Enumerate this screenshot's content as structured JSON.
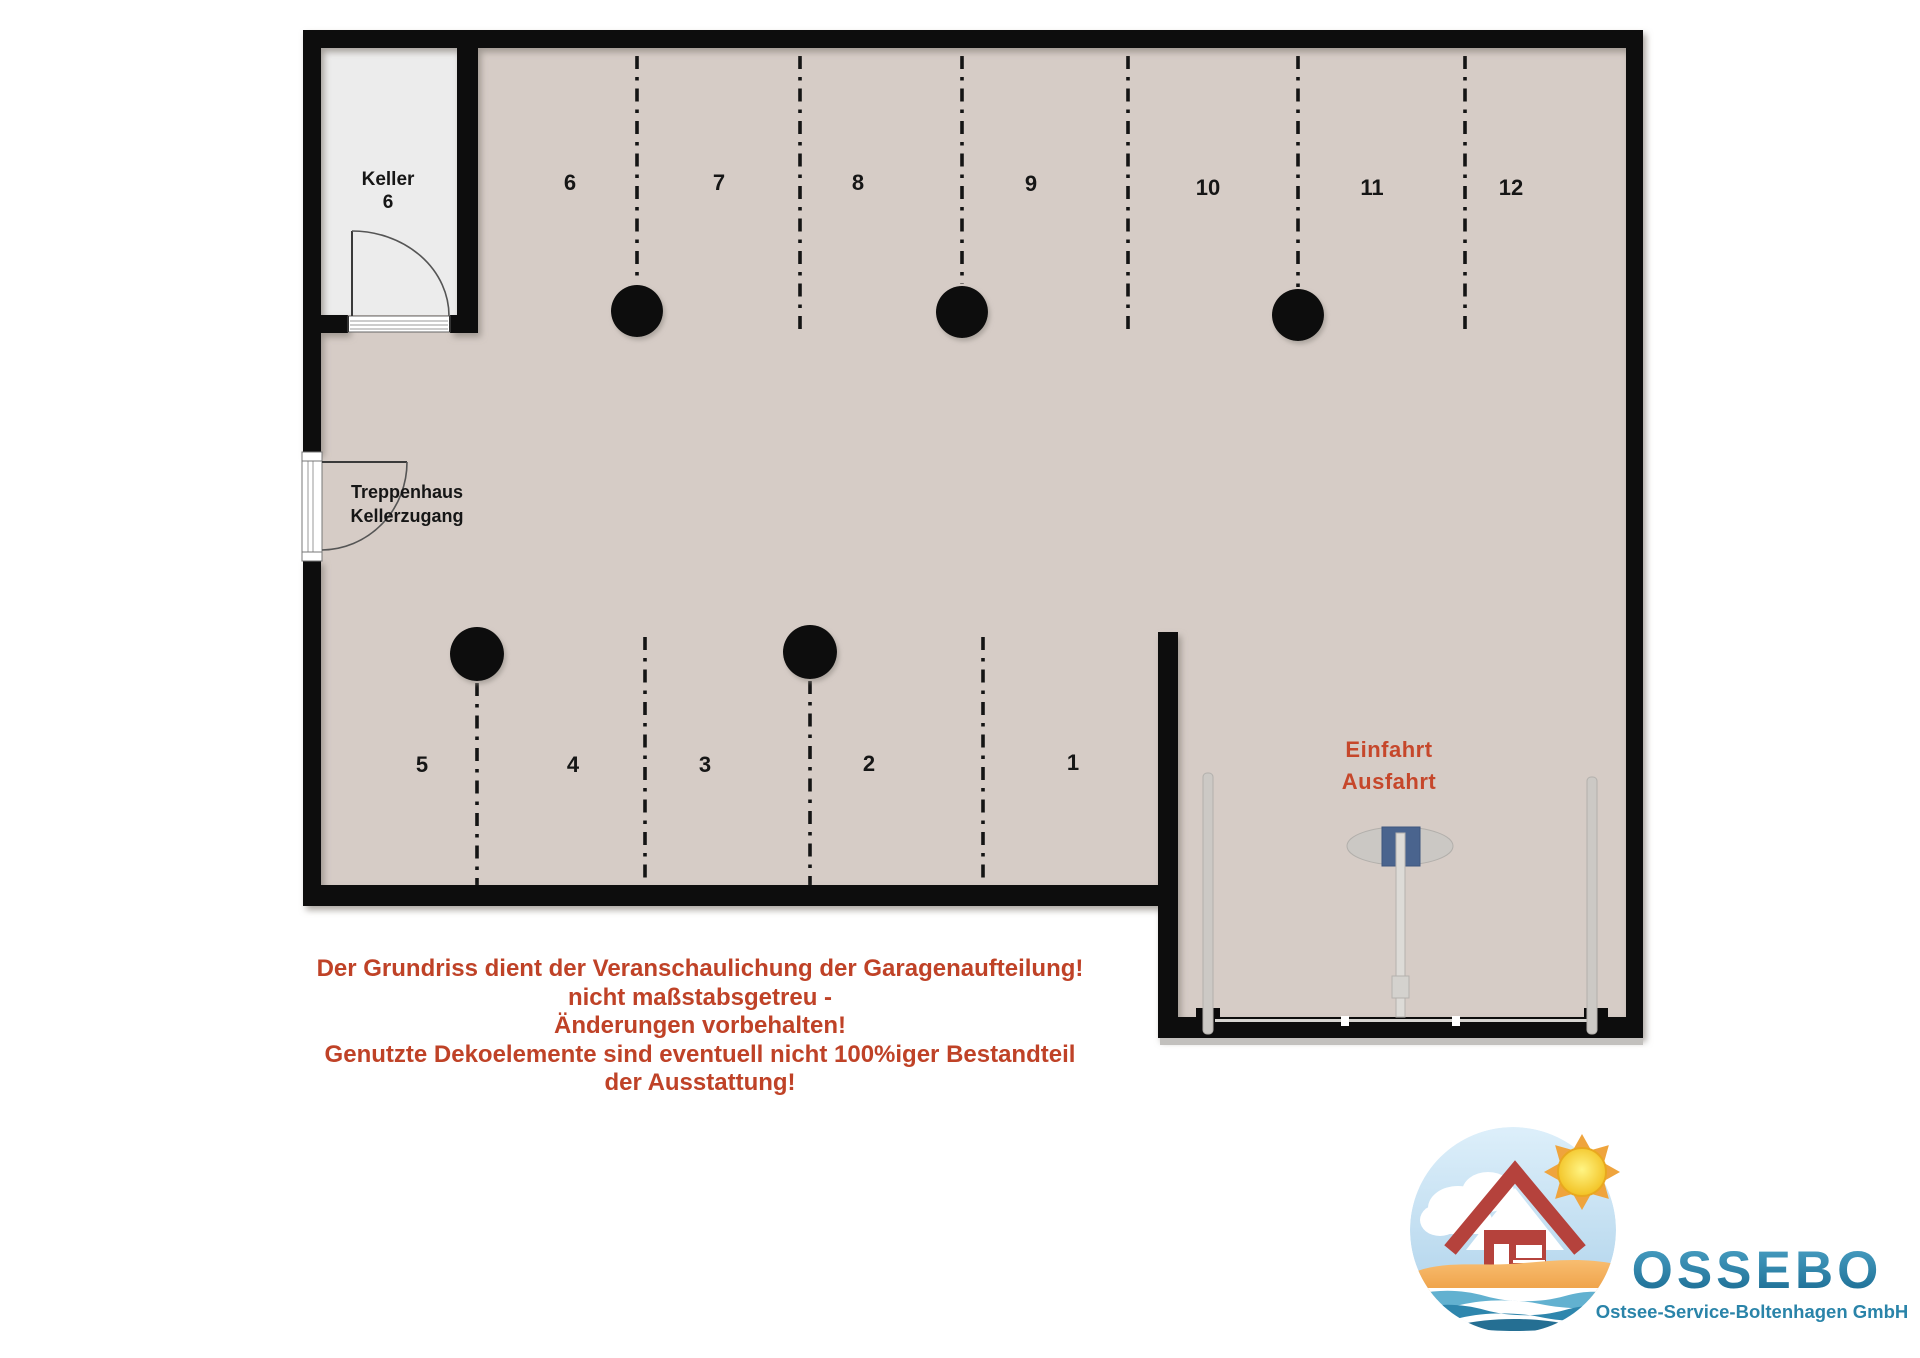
{
  "plan": {
    "keller": {
      "line1": "Keller",
      "line2": "6"
    },
    "stairwell": {
      "line1": "Treppenhaus",
      "line2": "Kellerzugang"
    },
    "entrance": {
      "line1": "Einfahrt",
      "line2": "Ausfahrt"
    },
    "spaces_top": [
      "6",
      "7",
      "8",
      "9",
      "10",
      "11",
      "12"
    ],
    "spaces_bottom": [
      "5",
      "4",
      "3",
      "2",
      "1"
    ]
  },
  "disclaimer": {
    "lines": [
      "Der Grundriss dient der Veranschaulichung der Garagenaufteilung!",
      "nicht maßstabsgetreu -",
      "Änderungen vorbehalten!",
      "Genutzte Dekoelemente sind eventuell nicht 100%iger Bestandteil",
      "der Ausstattung!"
    ]
  },
  "logo": {
    "name": "OSSEBO",
    "subtitle": "Ostsee-Service-Boltenhagen GmbH"
  },
  "colors": {
    "floor": "#d6ccc6",
    "keller_floor": "#ececec",
    "wall": "#0b0b0b",
    "accent_red": "#c6472b",
    "disclaimer_red": "#bf4227",
    "logo_blue": "#2a84a9",
    "gate_blue": "#4a648e"
  }
}
